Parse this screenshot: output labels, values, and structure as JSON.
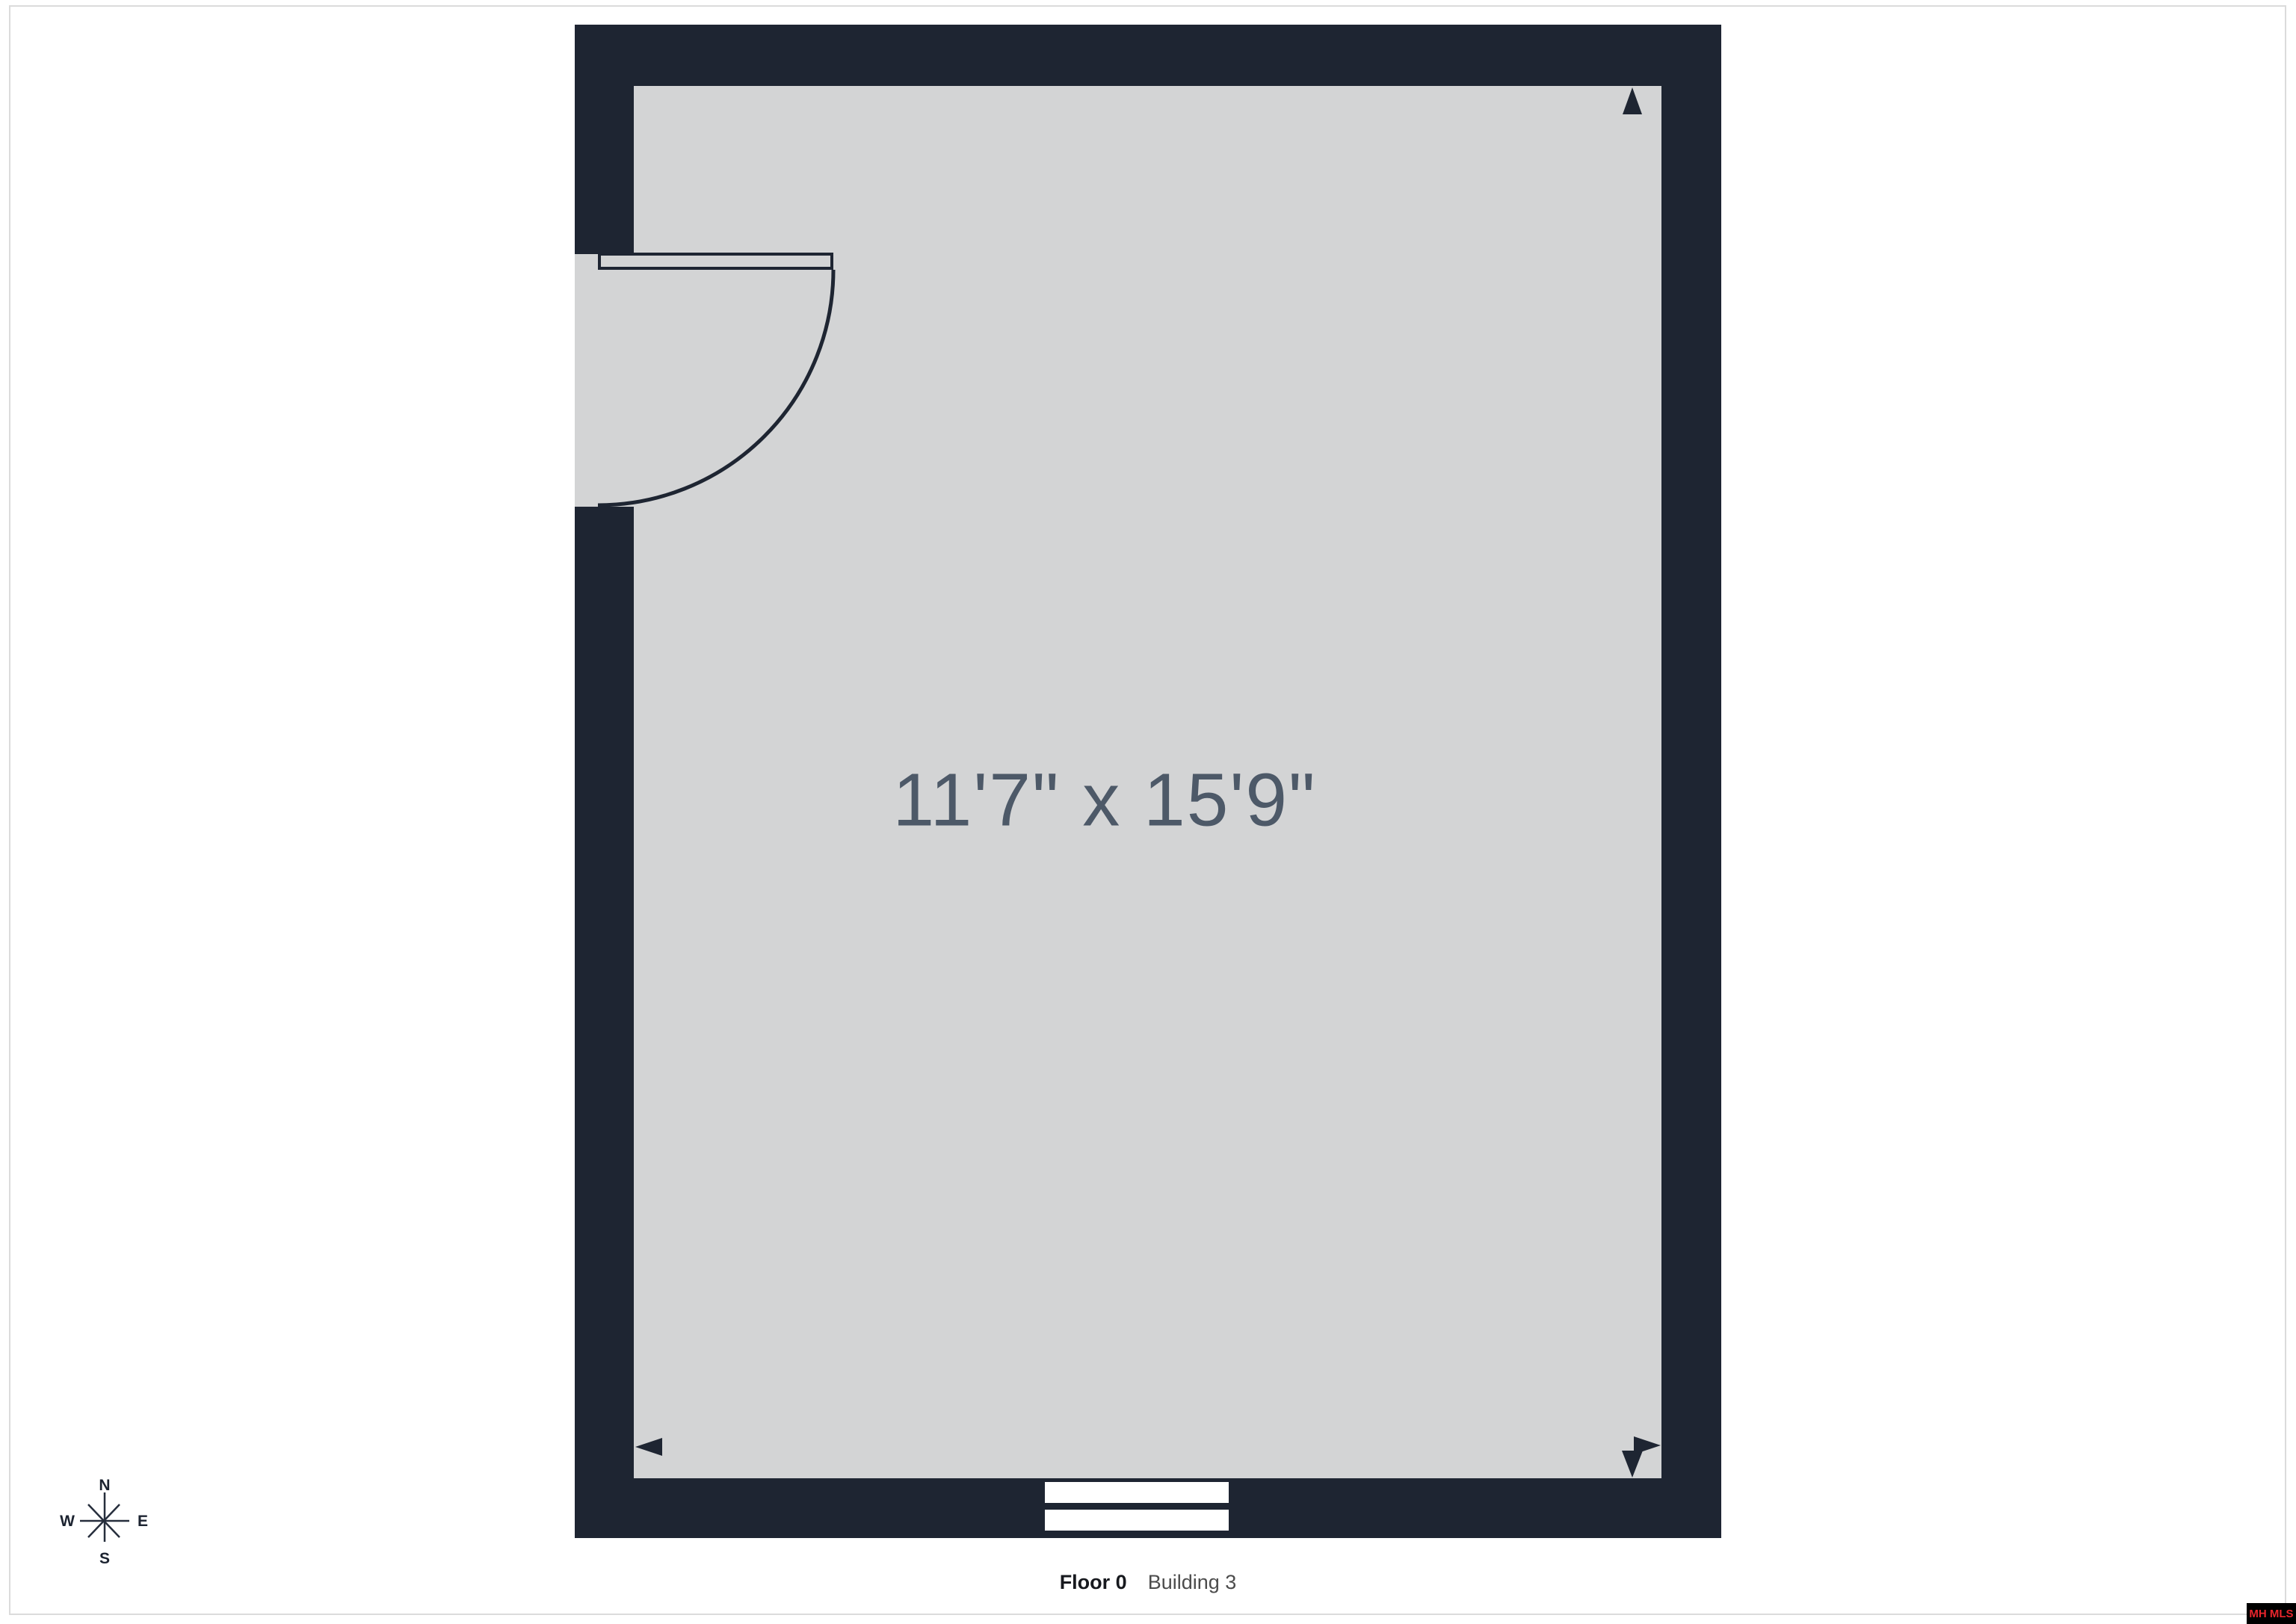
{
  "page": {
    "background": "#ffffff",
    "border_color": "#dbdbdb"
  },
  "floorplan": {
    "room": {
      "dimensions_label": "11'7\" x 15'9\"",
      "wall_color": "#1e2532",
      "floor_color": "#d3d4d5",
      "dimension_text_color": "#4d5968"
    },
    "features": {
      "door": "hinged door with quarter-circle swing, top-left wall",
      "window": "double-pane window symbol, bottom wall",
      "markers": [
        "arrow-up top-right",
        "arrow-left bottom-left",
        "arrow-right bottom-right",
        "arrow-down bottom-right"
      ]
    }
  },
  "compass": {
    "north": "N",
    "east": "E",
    "south": "S",
    "west": "W"
  },
  "caption": {
    "floor": "Floor 0",
    "building": "Building 3"
  },
  "watermark": {
    "text": "MH MLS",
    "text_color": "#e8252c",
    "bg_color": "#000000"
  }
}
